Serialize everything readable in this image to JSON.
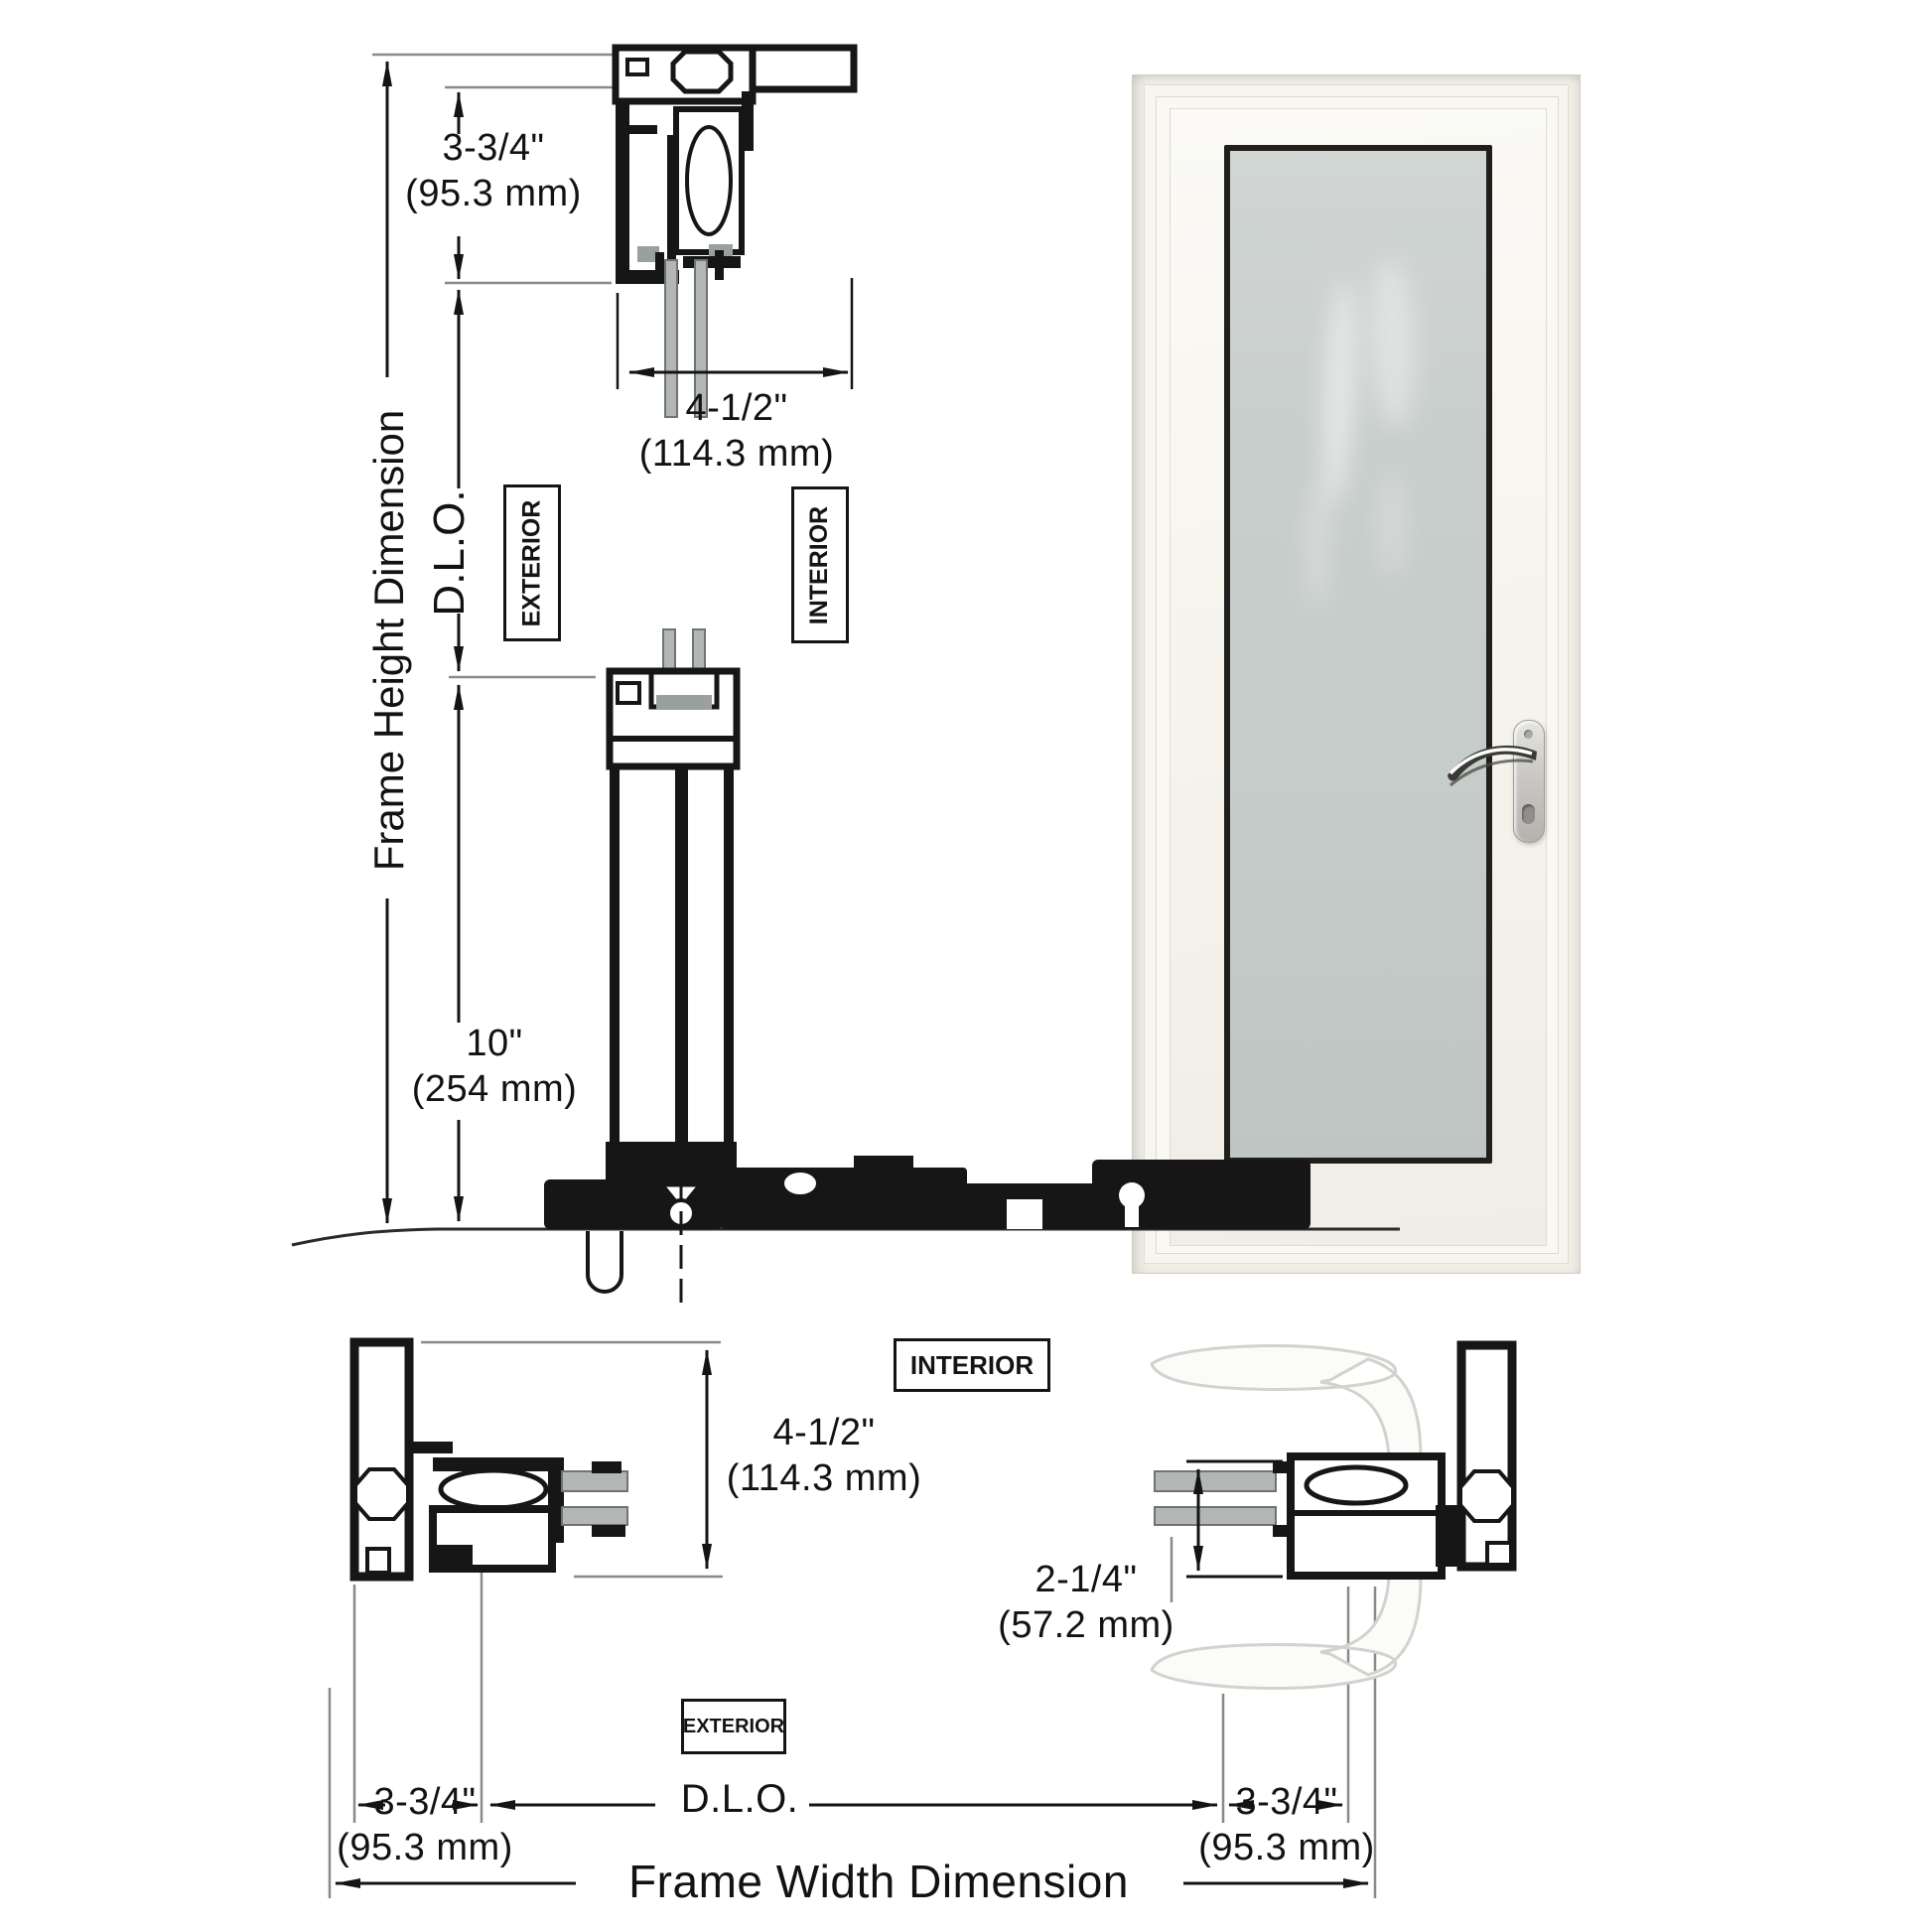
{
  "labels": {
    "frame_height": "Frame Height Dimension",
    "frame_width": "Frame Width Dimension",
    "dlo_side": "D.L.O.",
    "dlo_bottom": "D.L.O."
  },
  "tags": {
    "exterior_top": "EXTERIOR",
    "interior_top": "INTERIOR",
    "interior_bottom": "INTERIOR",
    "exterior_bottom": "EXTERIOR"
  },
  "dims": {
    "head": {
      "in": "3-3/4\"",
      "mm": "(95.3 mm)"
    },
    "frame_depth_top": {
      "in": "4-1/2\"",
      "mm": "(114.3 mm)"
    },
    "sill_riser": {
      "in": "10\"",
      "mm": "(254 mm)"
    },
    "frame_depth_side": {
      "in": "4-1/2\"",
      "mm": "(114.3 mm)"
    },
    "lock_stile": {
      "in": "2-1/4\"",
      "mm": "(57.2 mm)"
    },
    "jamb_left": {
      "in": "3-3/4\"",
      "mm": "(95.3 mm)"
    },
    "jamb_right": {
      "in": "3-3/4\"",
      "mm": "(95.3 mm)"
    }
  },
  "colors": {
    "line": "#161616",
    "extension_line": "#8a8a8a",
    "section_glass": "#b2b7b5",
    "section_gasket": "#9aa09e",
    "door_frame": "#f1efe8",
    "door_glass": "#c8cecc",
    "handle_metal": "#c9c8c4",
    "glazing_bead": "#201f1b"
  }
}
